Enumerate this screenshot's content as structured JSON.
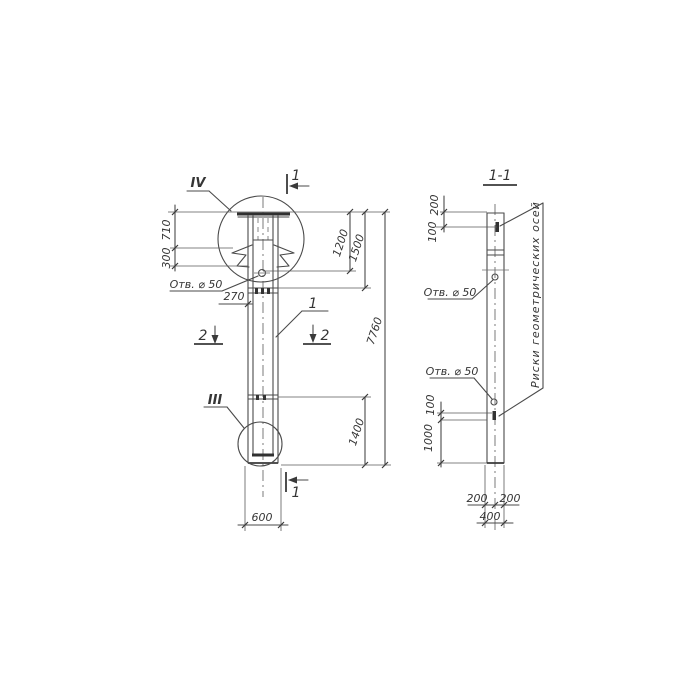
{
  "left_view": {
    "detail_label_top": "IV",
    "detail_label_bottom": "III",
    "part_callout": "1",
    "section_marker_top": "1",
    "section_marker_bottom": "1",
    "section_marker_left": "2",
    "section_marker_right": "2",
    "hole_label": "Отв. ⌀ 50",
    "dim_710": "710",
    "dim_300": "300",
    "dim_270": "270",
    "dim_1200": "1200",
    "dim_1500": "1500",
    "dim_7760": "7760",
    "dim_1400": "1400",
    "dim_600": "600"
  },
  "right_view": {
    "title": "1-1",
    "hole_label_upper": "Отв. ⌀ 50",
    "hole_label_lower": "Отв. ⌀ 50",
    "axes_note": "Риски геометрических осей",
    "dim_200_top": "200",
    "dim_100_top": "100",
    "dim_100_bottom": "100",
    "dim_1000": "1000",
    "dim_200_bottom_left": "200",
    "dim_200_bottom_right": "200",
    "dim_400": "400"
  }
}
